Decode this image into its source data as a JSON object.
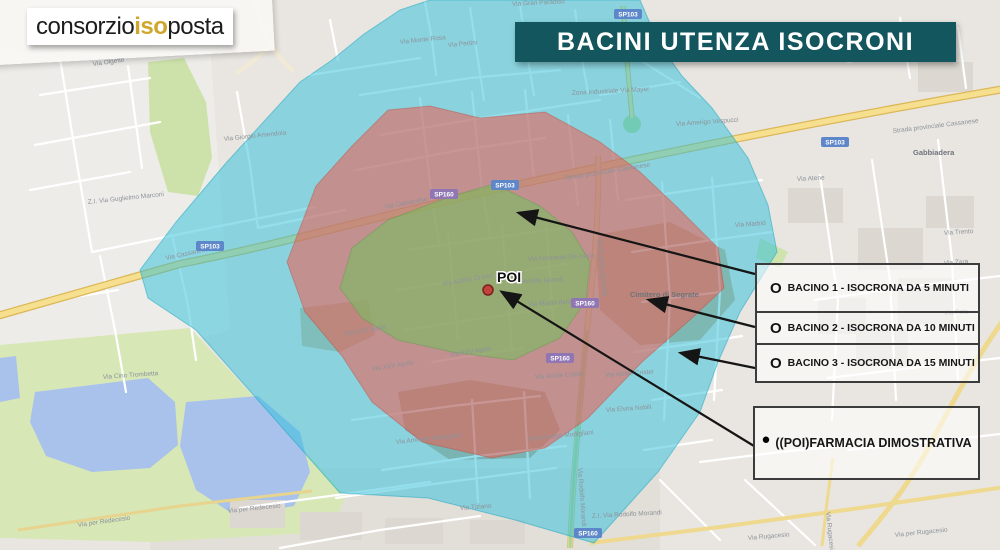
{
  "logo": {
    "part1": "consorzio",
    "part2": "iso",
    "part3": "posta"
  },
  "title": "BACINI UTENZA ISOCRONI",
  "legend": {
    "items": [
      {
        "bullet": "O",
        "label": "BACINO 1 - ISOCRONA DA 5 MINUTI"
      },
      {
        "bullet": "O",
        "label": "BACINO 2 - ISOCRONA DA 10 MINUTI"
      },
      {
        "bullet": "O",
        "label": "BACINO 3 - ISOCRONA DA 15 MINUTI"
      }
    ],
    "poi_item": {
      "bullet": "●",
      "label": "((POI)FARMACIA DIMOSTRATIVA"
    }
  },
  "map": {
    "poi_label": "POI",
    "zones": {
      "bacino1_color": "#72c15c",
      "bacino2_color": "#f15a4d",
      "bacino3_color": "#2cc0db"
    },
    "road_badges": [
      {
        "t": "SP103",
        "x": 210,
        "y": 246,
        "c": "b"
      },
      {
        "t": "SP160",
        "x": 444,
        "y": 194,
        "c": "p"
      },
      {
        "t": "SP103",
        "x": 505,
        "y": 185,
        "c": "b"
      },
      {
        "t": "SP103",
        "x": 835,
        "y": 142,
        "c": "b"
      },
      {
        "t": "SP103",
        "x": 628,
        "y": 14,
        "c": "b"
      },
      {
        "t": "SP160",
        "x": 585,
        "y": 303,
        "c": "p"
      },
      {
        "t": "SP160",
        "x": 560,
        "y": 358,
        "c": "p"
      },
      {
        "t": "SP160",
        "x": 588,
        "y": 533,
        "c": "b"
      }
    ],
    "street_labels": [
      {
        "t": "Via Olgette",
        "x": 93,
        "y": 66,
        "r": -8
      },
      {
        "t": "Z.I. Via Guglielmo Marconi",
        "x": 88,
        "y": 204,
        "r": -6
      },
      {
        "t": "Via Giorgio Amendola",
        "x": 224,
        "y": 141,
        "r": -6
      },
      {
        "t": "Via Cassanese",
        "x": 166,
        "y": 260,
        "r": -12
      },
      {
        "t": "Via Cassanese",
        "x": 385,
        "y": 209,
        "r": -11
      },
      {
        "t": "Strada provinciale Cassanese",
        "x": 565,
        "y": 180,
        "r": -9
      },
      {
        "t": "Strada provinciale Cassanese",
        "x": 893,
        "y": 133,
        "r": -7
      },
      {
        "t": "Gabbiadera",
        "x": 913,
        "y": 155,
        "r": 0,
        "cls": "place"
      },
      {
        "t": "Via Amerigo Vespucci",
        "x": 676,
        "y": 126,
        "r": -4
      },
      {
        "t": "Via Madrid",
        "x": 735,
        "y": 227,
        "r": -4
      },
      {
        "t": "Via Rodolfo Morandi",
        "x": 597,
        "y": 238,
        "r": 84
      },
      {
        "t": "Via Rodolfo Morandi",
        "x": 578,
        "y": 468,
        "r": 86
      },
      {
        "t": "Via XXV Aprile",
        "x": 372,
        "y": 371,
        "r": -9
      },
      {
        "t": "Via XXV Aprile",
        "x": 450,
        "y": 357,
        "r": -9
      },
      {
        "t": "Via Amedeo Modigliani",
        "x": 396,
        "y": 444,
        "r": -6
      },
      {
        "t": "Via Amedeo Modigliani",
        "x": 528,
        "y": 441,
        "r": -6
      },
      {
        "t": "Via Achille Grandi",
        "x": 512,
        "y": 284,
        "r": -3
      },
      {
        "t": "Via Achille Grandi",
        "x": 443,
        "y": 286,
        "r": -10
      },
      {
        "t": "Via Fernando De Ascia",
        "x": 528,
        "y": 261,
        "r": -3
      },
      {
        "t": "Via Martiri della Libertà",
        "x": 528,
        "y": 306,
        "r": -3
      },
      {
        "t": "Via Alcide Cristei",
        "x": 535,
        "y": 379,
        "r": -4
      },
      {
        "t": "Via Alcide Cristei",
        "x": 605,
        "y": 377,
        "r": -4
      },
      {
        "t": "Via per Redecesio",
        "x": 78,
        "y": 527,
        "r": -8
      },
      {
        "t": "Via per Redecesio",
        "x": 228,
        "y": 513,
        "r": -6
      },
      {
        "t": "Via Cino Trombetta",
        "x": 103,
        "y": 379,
        "r": -4
      },
      {
        "t": "Via per Rugacesio",
        "x": 895,
        "y": 537,
        "r": -6
      },
      {
        "t": "Via Rugacesio",
        "x": 826,
        "y": 512,
        "r": 84
      },
      {
        "t": "Via Rugacesio",
        "x": 748,
        "y": 540,
        "r": -5
      },
      {
        "t": "Cimitero di Segrate",
        "x": 630,
        "y": 297,
        "r": 0,
        "cls": "place"
      },
      {
        "t": "Z.I. Via Rodolfo Morandi",
        "x": 592,
        "y": 518,
        "r": -3
      },
      {
        "t": "Via Tiziano",
        "x": 460,
        "y": 510,
        "r": -4
      },
      {
        "t": "Via Monte Rosa",
        "x": 400,
        "y": 44,
        "r": -6
      },
      {
        "t": "Via Pertini",
        "x": 448,
        "y": 47,
        "r": -5
      },
      {
        "t": "Via Gran Paradiso",
        "x": 512,
        "y": 6,
        "r": -3
      },
      {
        "t": "Zona Industriale Via Mayer",
        "x": 572,
        "y": 95,
        "r": -3
      },
      {
        "t": "Via Trento",
        "x": 944,
        "y": 235,
        "r": -4
      },
      {
        "t": "Via Zara",
        "x": 944,
        "y": 265,
        "r": -4
      },
      {
        "t": "Via Pola",
        "x": 944,
        "y": 315,
        "r": -4
      },
      {
        "t": "Via Atene",
        "x": 797,
        "y": 181,
        "r": -3
      },
      {
        "t": "Via Elvira Nobili",
        "x": 606,
        "y": 412,
        "r": -4
      },
      {
        "t": "Via XXV Aprile",
        "x": 345,
        "y": 336,
        "r": -10
      }
    ]
  }
}
